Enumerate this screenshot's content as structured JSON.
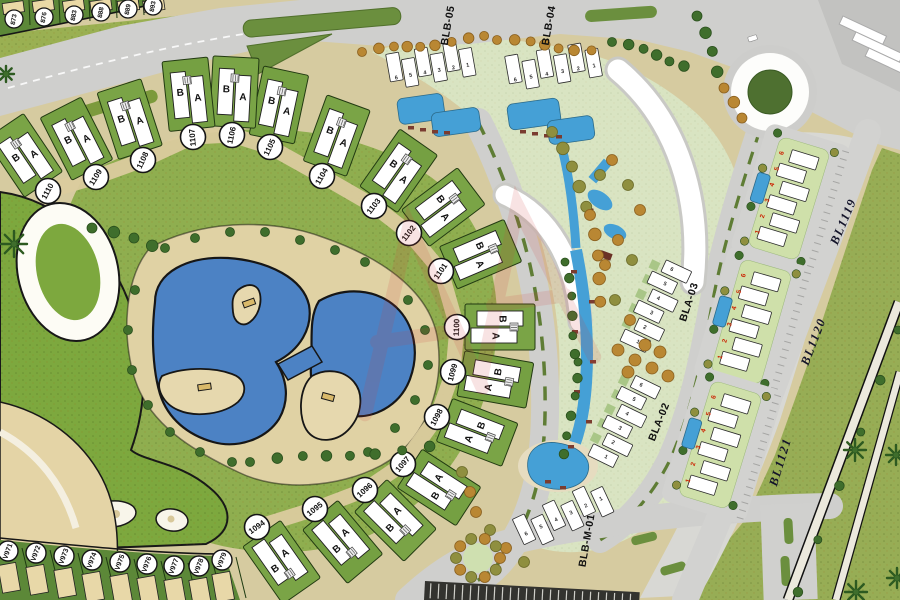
{
  "map": {
    "arc_villa_numbers": [
      "1094",
      "1095",
      "1096",
      "1097",
      "1098",
      "1099",
      "1100",
      "1101",
      "1102",
      "1103",
      "1104",
      "1105",
      "1106",
      "1107",
      "1108",
      "1109",
      "1110"
    ],
    "v_villa_numbers": [
      "V971",
      "V972",
      "V973",
      "V974",
      "V975",
      "V976",
      "V977",
      "V978",
      "V979"
    ],
    "top_plot_numbers": [
      "873",
      "876",
      "883",
      "888",
      "889",
      "893"
    ],
    "unit_letters": {
      "a": "A",
      "b": "B"
    },
    "building_unit_numbers": [
      "1",
      "2",
      "3",
      "4",
      "5",
      "6"
    ],
    "block_labels": {
      "blb05": "BLB-05",
      "blb04": "BLB-04",
      "bla03": "BLA-03",
      "bla02": "BLA-02",
      "blbm01": "BLB-M-01",
      "bl1119": "BL1119",
      "bl1120": "BL1120",
      "bl1121": "BL1121"
    },
    "colors": {
      "water": "#4c82c4",
      "pool": "#45a0d6",
      "lawn": "#8fae4f",
      "sand": "#ddcfa2",
      "road": "#cfcfcd",
      "plot_green": "#79a344",
      "building": "#ffffff",
      "tree_olive": "#8f8f3f",
      "tree_orange": "#b98733",
      "tree_dark": "#3f6e2c",
      "median": "#6b8f3e",
      "cluster_number": "#cc2200",
      "roundabout_center": "#4e7030"
    }
  }
}
